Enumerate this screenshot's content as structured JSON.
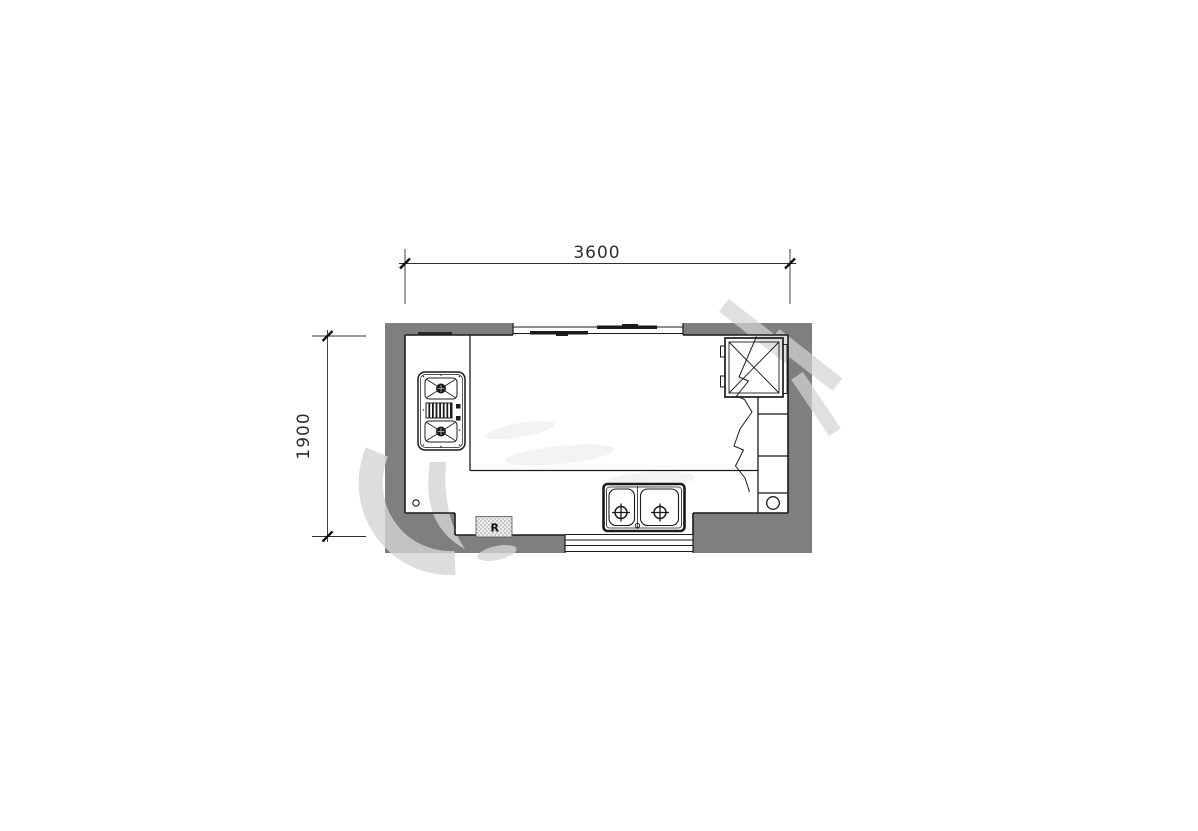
{
  "meta": {
    "type": "architectural-floor-plan",
    "subject": "kitchen-plan-with-u-shaped-counter"
  },
  "dimensions": {
    "top": "3600",
    "left": "1900"
  },
  "labels": {
    "hatched_box": "R"
  },
  "colors": {
    "background": "#ffffff",
    "wall": "#7f7f7f",
    "line": "#1b1b1b",
    "dimension": "#2f2f2f",
    "watermark": "#d5d5d5"
  },
  "fixtures": [
    {
      "name": "gas-cooktop-2-burner",
      "location": "left-counter"
    },
    {
      "name": "double-bowl-sink",
      "location": "bottom-counter"
    },
    {
      "name": "refrigerator-crossed-box",
      "location": "top-right-corner"
    },
    {
      "name": "tall-cabinet-with-break-line",
      "location": "right-side"
    },
    {
      "name": "round-fixture-in-cabinet",
      "location": "bottom-right"
    },
    {
      "name": "hatched-appliance-box",
      "location": "bottom-left-wall"
    },
    {
      "name": "sliding-window",
      "location": "top-wall"
    },
    {
      "name": "window",
      "location": "bottom-wall"
    },
    {
      "name": "floor-drain-circle",
      "location": "bottom-left-floor"
    }
  ]
}
